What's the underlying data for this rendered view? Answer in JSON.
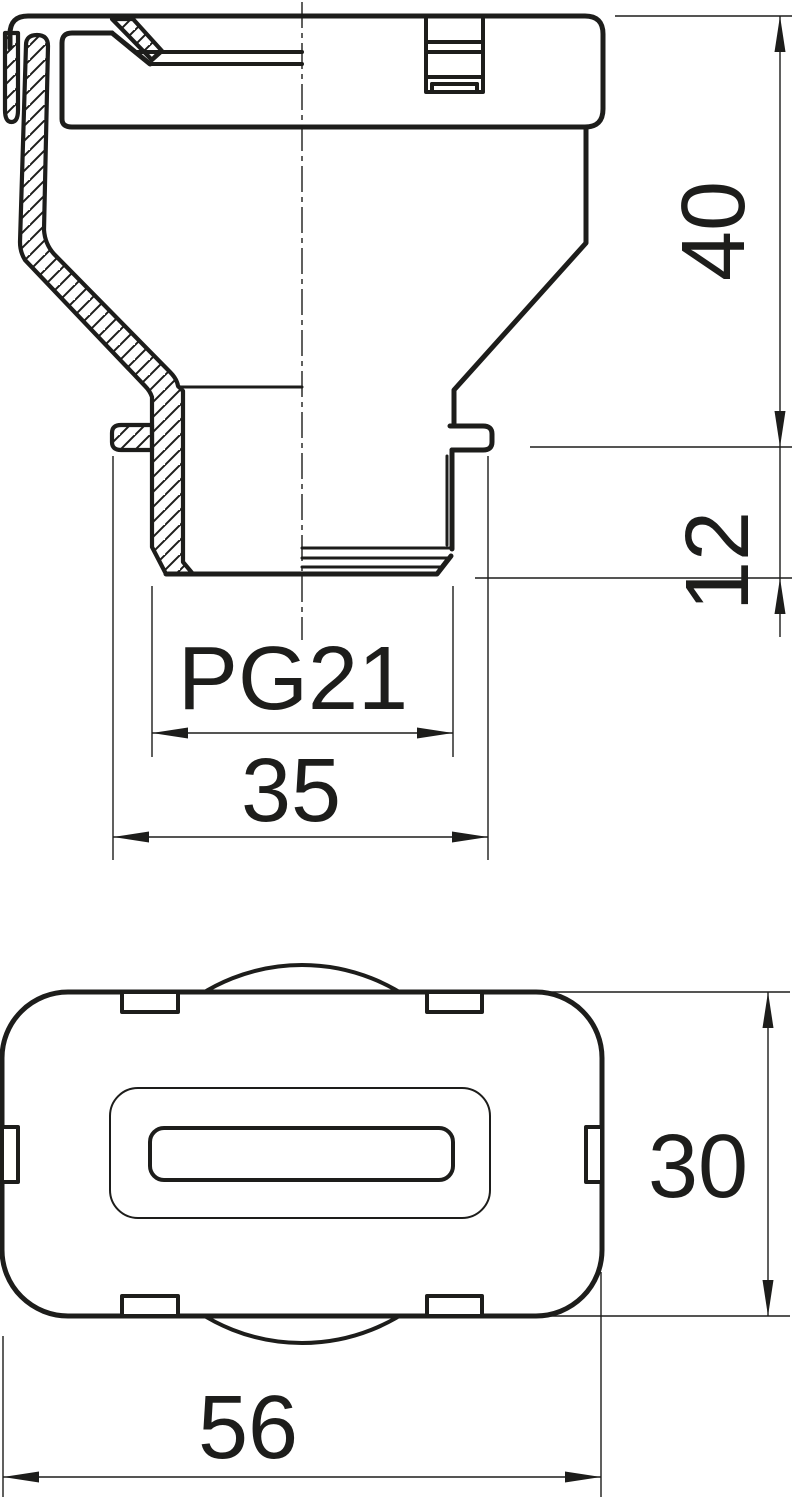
{
  "drawing": {
    "line_color": "#1d1d1b",
    "background": "#ffffff",
    "labels": {
      "dim_upper_height": "40",
      "dim_thread_length": "12",
      "thread_size": "PG21",
      "dim_flange_diameter": "35",
      "dim_body_height": "30",
      "dim_body_width": "56"
    }
  }
}
